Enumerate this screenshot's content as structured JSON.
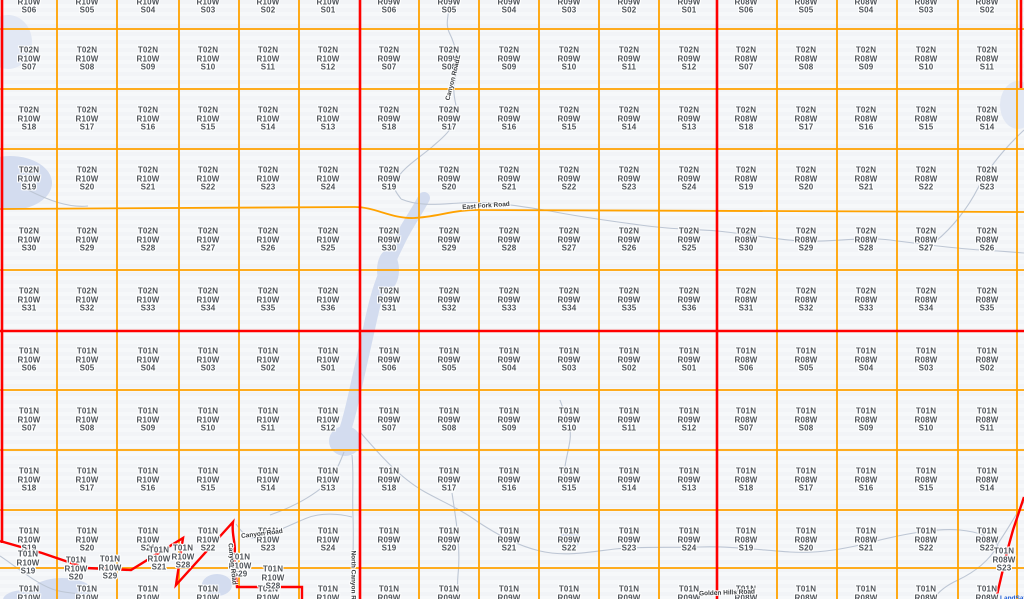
{
  "canvas": {
    "width": 1024,
    "height": 599
  },
  "colors": {
    "background": "#f4f6f8",
    "section_line": "#ffa200",
    "township_line": "#ff0000",
    "label_text": "#4f545a",
    "water": "#d3dcef",
    "water_faint": "#e2e8f4",
    "stream": "#bdc6d4",
    "road_label_text": "#3a3d40",
    "attribution_text": "#1a5ad7"
  },
  "grid": {
    "orange_verticals": [
      57,
      117,
      179,
      239,
      299,
      419,
      479,
      539,
      599,
      659,
      777,
      837,
      897,
      958,
      1017
    ],
    "orange_horizontals": [
      29,
      89,
      149,
      270,
      390,
      450,
      510,
      568
    ],
    "orange_jog_path": "M0,209 L355,207 C375,207 392,219 414,218 C437,217 456,209 481,210 L1024,212",
    "red_verticals": [
      {
        "x": 2,
        "y1": 0,
        "y2": 543
      },
      {
        "x": 360,
        "y1": 0,
        "y2": 599
      },
      {
        "x": 717,
        "y1": 0,
        "y2": 599
      },
      {
        "x": 1021,
        "y1": 0,
        "y2": 88
      }
    ],
    "red_horizontals": [
      {
        "y": 331,
        "x1": 0,
        "x2": 1024
      }
    ],
    "red_boundary_paths": [
      "M0,541 L42,553 L86,568 L131,570 L183,538 L176,585 L233,522 C231,535 237,545 234,557 L237,587 L302,587 L302,599",
      "M1024,497 L1013,530 L1008,548 L996,599"
    ]
  },
  "townships": [
    {
      "township": "T02N",
      "range": "R10W",
      "col_x": [
        29,
        87,
        148,
        208,
        268,
        328
      ],
      "rows": [
        {
          "y": 2,
          "sections": [
            "S06",
            "S05",
            "S04",
            "S03",
            "S02",
            "S01"
          ]
        },
        {
          "y": 59,
          "sections": [
            "S07",
            "S08",
            "S09",
            "S10",
            "S11",
            "S12"
          ]
        },
        {
          "y": 119,
          "sections": [
            "S18",
            "S17",
            "S16",
            "S15",
            "S14",
            "S13"
          ]
        },
        {
          "y": 179,
          "sections": [
            "S19",
            "S20",
            "S21",
            "S22",
            "S23",
            "S24"
          ]
        },
        {
          "y": 240,
          "sections": [
            "S30",
            "S29",
            "S28",
            "S27",
            "S26",
            "S25"
          ]
        },
        {
          "y": 300,
          "sections": [
            "S31",
            "S32",
            "S33",
            "S34",
            "S35",
            "S36"
          ]
        }
      ]
    },
    {
      "township": "T02N",
      "range": "R09W",
      "col_x": [
        389,
        449,
        509,
        569,
        629,
        689
      ],
      "rows": [
        {
          "y": 2,
          "sections": [
            "S06",
            "S05",
            "S04",
            "S03",
            "S02",
            "S01"
          ]
        },
        {
          "y": 59,
          "sections": [
            "S07",
            "S08",
            "S09",
            "S10",
            "S11",
            "S12"
          ]
        },
        {
          "y": 119,
          "sections": [
            "S18",
            "S17",
            "S16",
            "S15",
            "S14",
            "S13"
          ]
        },
        {
          "y": 179,
          "sections": [
            "S19",
            "S20",
            "S21",
            "S22",
            "S23",
            "S24"
          ]
        },
        {
          "y": 240,
          "sections": [
            "S30",
            "S29",
            "S28",
            "S27",
            "S26",
            "S25"
          ]
        },
        {
          "y": 300,
          "sections": [
            "S31",
            "S32",
            "S33",
            "S34",
            "S35",
            "S36"
          ]
        }
      ]
    },
    {
      "township": "T02N",
      "range": "R08W",
      "col_x": [
        746,
        806,
        866,
        926,
        987
      ],
      "rows": [
        {
          "y": 2,
          "sections": [
            "S06",
            "S05",
            "S04",
            "S03",
            "S02"
          ]
        },
        {
          "y": 59,
          "sections": [
            "S07",
            "S08",
            "S09",
            "S10",
            "S11"
          ]
        },
        {
          "y": 119,
          "sections": [
            "S18",
            "S17",
            "S16",
            "S15",
            "S14"
          ]
        },
        {
          "y": 179,
          "sections": [
            "S19",
            "S20",
            "S21",
            "S22",
            "S23"
          ]
        },
        {
          "y": 240,
          "sections": [
            "S30",
            "S29",
            "S28",
            "S27",
            "S26"
          ]
        },
        {
          "y": 300,
          "sections": [
            "S31",
            "S32",
            "S33",
            "S34",
            "S35"
          ]
        }
      ]
    },
    {
      "township": "T01N",
      "range": "R10W",
      "col_x": [
        29,
        87,
        148,
        208,
        268,
        328
      ],
      "rows": [
        {
          "y": 360,
          "sections": [
            "S06",
            "S05",
            "S04",
            "S03",
            "S02",
            "S01"
          ]
        },
        {
          "y": 420,
          "sections": [
            "S07",
            "S08",
            "S09",
            "S10",
            "S11",
            "S12"
          ]
        },
        {
          "y": 480,
          "sections": [
            "S18",
            "S17",
            "S16",
            "S15",
            "S14",
            "S13"
          ]
        },
        {
          "y": 540,
          "sections": [
            "S19",
            "S20",
            "S21",
            "S22",
            "S23",
            "S24"
          ]
        },
        {
          "y": 598,
          "sections": [
            "S30",
            "S29",
            "S28",
            "S27",
            "S26",
            "S25"
          ]
        }
      ]
    },
    {
      "township": "T01N",
      "range": "R09W",
      "col_x": [
        389,
        449,
        509,
        569,
        629,
        689
      ],
      "rows": [
        {
          "y": 360,
          "sections": [
            "S06",
            "S05",
            "S04",
            "S03",
            "S02",
            "S01"
          ]
        },
        {
          "y": 420,
          "sections": [
            "S07",
            "S08",
            "S09",
            "S10",
            "S11",
            "S12"
          ]
        },
        {
          "y": 480,
          "sections": [
            "S18",
            "S17",
            "S16",
            "S15",
            "S14",
            "S13"
          ]
        },
        {
          "y": 540,
          "sections": [
            "S19",
            "S20",
            "S21",
            "S22",
            "S23",
            "S24"
          ]
        },
        {
          "y": 598,
          "sections": [
            "S30",
            "S29",
            "S28",
            "S27",
            "S26",
            "S25"
          ]
        }
      ]
    },
    {
      "township": "T01N",
      "range": "R08W",
      "col_x": [
        746,
        806,
        866,
        926,
        987
      ],
      "rows": [
        {
          "y": 360,
          "sections": [
            "S06",
            "S05",
            "S04",
            "S03",
            "S02"
          ]
        },
        {
          "y": 420,
          "sections": [
            "S07",
            "S08",
            "S09",
            "S10",
            "S11"
          ]
        },
        {
          "y": 480,
          "sections": [
            "S18",
            "S17",
            "S16",
            "S15",
            "S14"
          ]
        },
        {
          "y": 540,
          "sections": [
            "S19",
            "S20",
            "S21",
            "S22",
            "S23"
          ]
        },
        {
          "y": 598,
          "sections": [
            "S30",
            "S29",
            "S28",
            "S27",
            "S26"
          ]
        }
      ]
    }
  ],
  "extra_labels": [
    {
      "township": "T01N",
      "range": "R10W",
      "section": "S19",
      "x": 28,
      "y": 563
    },
    {
      "township": "T01N",
      "range": "R10W",
      "section": "S20",
      "x": 76,
      "y": 569
    },
    {
      "township": "T01N",
      "range": "R10W",
      "section": "S29",
      "x": 110,
      "y": 568
    },
    {
      "township": "T01N",
      "range": "R10W",
      "section": "S21",
      "x": 159,
      "y": 559
    },
    {
      "township": "T01N",
      "range": "R10W",
      "section": "S28",
      "x": 183,
      "y": 557
    },
    {
      "township": "T01N",
      "range": "R10W",
      "section": "S29",
      "x": 240,
      "y": 566
    },
    {
      "township": "T01N",
      "range": "R10W",
      "section": "S28",
      "x": 273,
      "y": 578
    },
    {
      "township": "T01N",
      "range": "R08W",
      "section": "S23",
      "x": 1004,
      "y": 560
    }
  ],
  "road_labels": [
    {
      "text": "East Fork Road",
      "x": 486,
      "y": 206,
      "rot": -4
    },
    {
      "text": "Canyon Road",
      "x": 453,
      "y": 80,
      "rot": -76
    },
    {
      "text": "Canyon Road",
      "x": 262,
      "y": 534,
      "rot": -7
    },
    {
      "text": "Canyon Road",
      "x": 232,
      "y": 564,
      "rot": 84
    },
    {
      "text": "North Canyon Road",
      "x": 353,
      "y": 581,
      "rot": 90
    },
    {
      "text": "Golden Hills Road",
      "x": 727,
      "y": 593,
      "rot": -2
    }
  ],
  "attribution": {
    "text": "LandSat",
    "x": 1000,
    "y": 595
  },
  "water_bodies": [
    {
      "type": "riverpath",
      "d": "M424,198 C415,215 405,228 398,244 C390,260 383,275 378,292 C373,308 370,325 366,342 C362,360 358,378 354,396 C350,414 346,430 340,444",
      "width": 12
    },
    {
      "type": "ellipse",
      "cx": 388,
      "cy": 270,
      "rx": 11,
      "ry": 20,
      "faint": false
    },
    {
      "type": "ellipse",
      "cx": 10,
      "cy": 183,
      "rx": 42,
      "ry": 27,
      "faint": false
    },
    {
      "type": "ellipse",
      "cx": 345,
      "cy": 441,
      "rx": 16,
      "ry": 15,
      "faint": false
    },
    {
      "type": "ellipse",
      "cx": 217,
      "cy": 585,
      "rx": 15,
      "ry": 11,
      "faint": false
    },
    {
      "type": "ellipse",
      "cx": 570,
      "cy": 539,
      "rx": 10,
      "ry": 10,
      "faint": false
    },
    {
      "type": "ellipse",
      "cx": 62,
      "cy": 591,
      "rx": 30,
      "ry": 13,
      "faint": false
    },
    {
      "type": "ellipse",
      "cx": 25,
      "cy": 600,
      "rx": 22,
      "ry": 10,
      "faint": false
    },
    {
      "type": "ellipse",
      "cx": 8,
      "cy": 42,
      "rx": 24,
      "ry": 27,
      "faint": true
    },
    {
      "type": "ellipse",
      "cx": 1018,
      "cy": 105,
      "rx": 18,
      "ry": 24,
      "faint": true
    }
  ],
  "streams": [
    "M447,0 C452,10 444,20 449,32 C457,48 459,63 455,80 C451,97 459,107 456,117 C452,131 441,139 432,147 C419,158 401,169 396,181 C392,190 398,194 401,199",
    "M401,199 C420,207 440,204 460,203 C490,201 520,206 550,211 C580,217 610,221 640,225 C675,230 695,229 717,231 C750,234 770,239 800,241 C830,243 860,236 890,240 C920,244 950,248 980,250 C1000,251 1012,252 1024,253",
    "M360,432 C380,455 400,478 425,492 C445,503 462,510 478,522 C495,533 515,545 540,551 C565,557 590,552 615,549 C645,546 675,548 700,547 C730,546 760,550 790,552 C820,554 850,548 880,540 C905,534 935,528 960,530 C980,532 992,538 998,545",
    "M998,545 C990,560 975,572 958,580 C945,586 938,592 934,599",
    "M1024,130 C1005,148 988,168 978,188 C968,208 952,228 936,241",
    "M236,524 C244,536 252,541 263,537 C276,532 292,524 307,518 C322,512 340,514 352,517",
    "M352,455 C354,475 352,495 353,517 C354,545 352,570 353,599",
    "M452,493 C456,520 461,548 458,575 C457,585 458,592 458,599",
    "M0,556 C18,568 34,582 52,589 C68,595 82,591 92,599",
    "M28,190 C48,200 68,208 88,206",
    "M1024,502 C1014,518 1006,532 997,545",
    "M270,515 C290,508 310,498 325,485 C335,476 340,462 344,452",
    "M560,400 C565,415 572,425 570,440 C568,455 562,470 565,485"
  ]
}
